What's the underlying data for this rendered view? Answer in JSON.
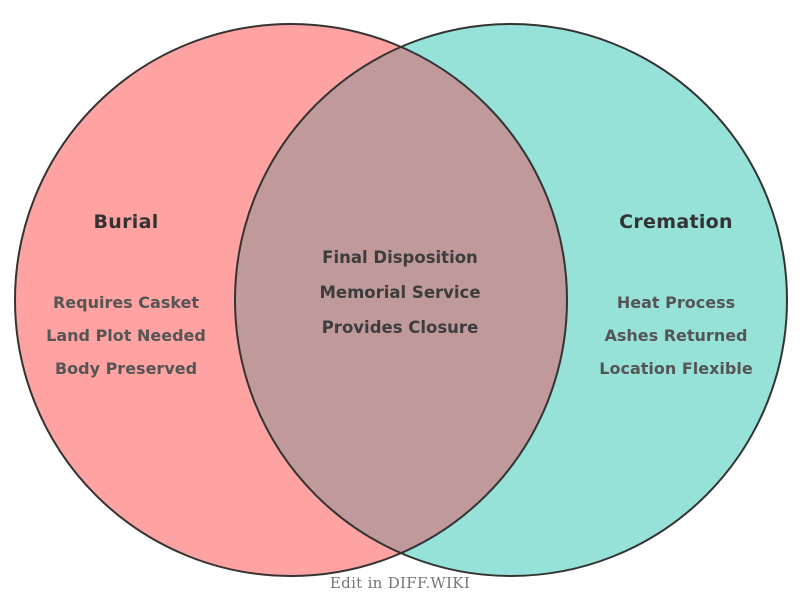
{
  "venn": {
    "left": {
      "title": "Burial",
      "items": [
        "Requires Casket",
        "Land Plot Needed",
        "Body Preserved"
      ],
      "color": "#FFA2A2"
    },
    "right": {
      "title": "Cremation",
      "items": [
        "Heat Process",
        "Ashes Returned",
        "Location Flexible"
      ],
      "color": "#96E2D8"
    },
    "intersection": {
      "items": [
        "Final Disposition",
        "Memorial Service",
        "Provides Closure"
      ],
      "color": "#C09A9A"
    },
    "outline_color": "#333333"
  },
  "colors": {
    "title": "#333333",
    "item": "#555555",
    "center_item": "#3d3d3d",
    "footer": "#757575"
  },
  "footer": {
    "label": "Edit in DIFF.WIKI"
  }
}
